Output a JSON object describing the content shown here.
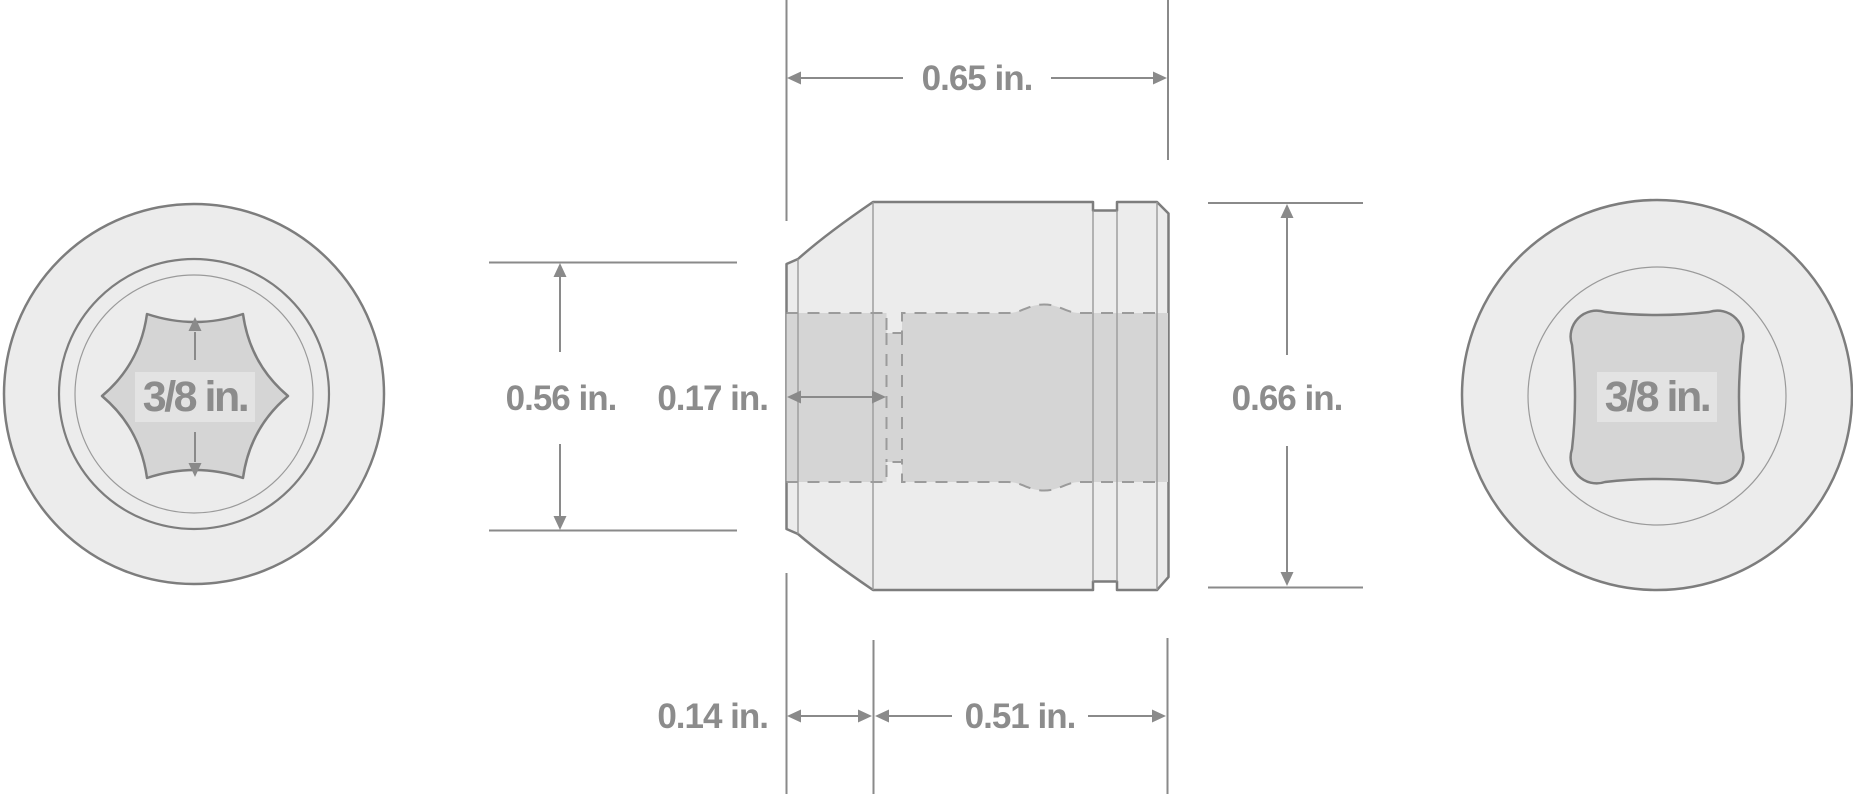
{
  "diagram": {
    "front_view": {
      "opening_label": "3/8 in."
    },
    "back_view": {
      "drive_label": "3/8 in."
    },
    "side_view_dimensions": {
      "overall_length": "0.65 in.",
      "front_opening_diameter": "0.56 in.",
      "opening_depth": "0.17 in.",
      "outer_diameter": "0.66 in.",
      "front_taper_length": "0.14 in.",
      "drive_end_length": "0.51 in."
    }
  },
  "colors": {
    "outline": "#7d7d7d",
    "thin_line": "#9a9a9a",
    "dash_line": "#9b9b9b",
    "dim_line": "#8a8a8a",
    "label": "#8c8c8c",
    "body_fill": "#ececec",
    "recess_fill": "#d5d5d5",
    "plate_fill": "#e3e3e3",
    "background": "#ffffff"
  }
}
